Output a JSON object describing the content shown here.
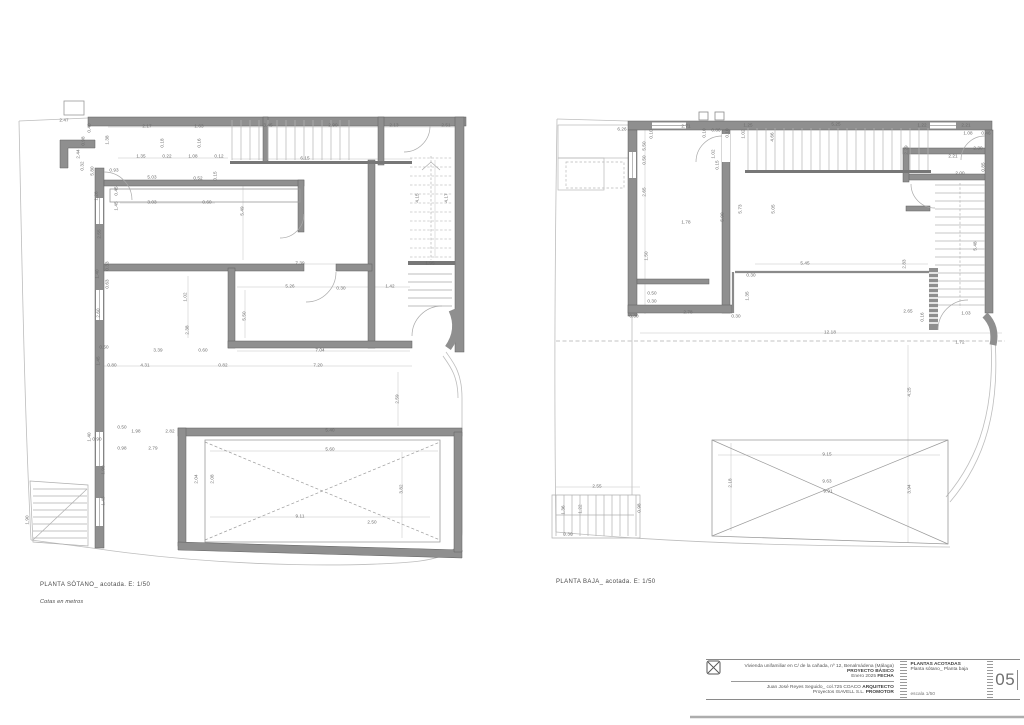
{
  "colors": {
    "wall": "#8f8f8f",
    "thin_line": "#a8a8a8",
    "dim_text": "#6a6a6a",
    "paper": "#ffffff"
  },
  "captions": {
    "left_title": "PLANTA SÓTANO_ acotada. E: 1/50",
    "left_note": "Cotas en metros",
    "right_title": "PLANTA BAJA_ acotada. E: 1/50"
  },
  "title_block": {
    "project_desc": "Vivienda unifamiliar en C/ de la cañada, nº 12, Benalmádena (Málaga)",
    "project_label": "PROYECTO BÁSICO",
    "date_value": "Enero 2025",
    "date_label": "FECHA",
    "architect_value": "Juan José Reyes Seguido_ col.725 COACO",
    "architect_label": "ARQUITECTO",
    "promoter_value": "Proyectos ISAVELL S.L.",
    "promoter_label": "PROMOTOR",
    "sheet_title": "PLANTAS ACOTADAS",
    "sheet_subtitle": "Planta sótano_ Planta baja",
    "scale_note": "escala 1/50",
    "sheet_number": "05"
  },
  "plans": {
    "left": {
      "dims": [
        {
          "x": 147,
          "y": 127,
          "t": "2.17"
        },
        {
          "x": 199,
          "y": 127,
          "t": "1.63"
        },
        {
          "x": 268,
          "y": 126,
          "t": "3.45"
        },
        {
          "x": 333,
          "y": 126,
          "t": "2.90"
        },
        {
          "x": 394,
          "y": 126,
          "t": "2.13"
        },
        {
          "x": 446,
          "y": 126,
          "t": "2.51"
        },
        {
          "x": 163,
          "y": 143,
          "t": "0.18",
          "r": 1
        },
        {
          "x": 200,
          "y": 143,
          "t": "0.16",
          "r": 1
        },
        {
          "x": 141,
          "y": 157,
          "t": "1.35"
        },
        {
          "x": 167,
          "y": 157,
          "t": "0.22"
        },
        {
          "x": 193,
          "y": 157,
          "t": "1.08"
        },
        {
          "x": 219,
          "y": 157,
          "t": "0.12"
        },
        {
          "x": 305,
          "y": 159,
          "t": "6.15"
        },
        {
          "x": 64,
          "y": 121,
          "t": "2.47"
        },
        {
          "x": 90,
          "y": 128,
          "t": "0.40",
          "r": 1
        },
        {
          "x": 84,
          "y": 141,
          "t": "0.98",
          "r": 1
        },
        {
          "x": 79,
          "y": 154,
          "t": "2.44",
          "r": 1
        },
        {
          "x": 83,
          "y": 166,
          "t": "0.32",
          "r": 1
        },
        {
          "x": 108,
          "y": 140,
          "t": "1.38",
          "r": 1
        },
        {
          "x": 93,
          "y": 171,
          "t": "5.80",
          "r": 1
        },
        {
          "x": 114,
          "y": 171,
          "t": "0.93"
        },
        {
          "x": 152,
          "y": 178,
          "t": "5.03"
        },
        {
          "x": 198,
          "y": 179,
          "t": "0.52"
        },
        {
          "x": 216,
          "y": 176,
          "t": "0.15",
          "r": 1
        },
        {
          "x": 117,
          "y": 191,
          "t": "0.45",
          "r": 1
        },
        {
          "x": 97,
          "y": 196,
          "t": "1.26",
          "r": 1
        },
        {
          "x": 152,
          "y": 203,
          "t": "3.03"
        },
        {
          "x": 207,
          "y": 203,
          "t": "0.60"
        },
        {
          "x": 117,
          "y": 206,
          "t": "1.45",
          "r": 1
        },
        {
          "x": 243,
          "y": 211,
          "t": "5.49",
          "r": 1
        },
        {
          "x": 100,
          "y": 234,
          "t": "2.55",
          "r": 1
        },
        {
          "x": 108,
          "y": 266,
          "t": "0.33",
          "r": 1
        },
        {
          "x": 98,
          "y": 274,
          "t": "1.40",
          "r": 1
        },
        {
          "x": 108,
          "y": 284,
          "t": "0.63",
          "r": 1
        },
        {
          "x": 300,
          "y": 264,
          "t": "7.39"
        },
        {
          "x": 290,
          "y": 287,
          "t": "5.26"
        },
        {
          "x": 341,
          "y": 289,
          "t": "0.30"
        },
        {
          "x": 390,
          "y": 287,
          "t": "1.42"
        },
        {
          "x": 186,
          "y": 297,
          "t": "1.02",
          "r": 1
        },
        {
          "x": 99,
          "y": 313,
          "t": "2.60",
          "r": 1
        },
        {
          "x": 188,
          "y": 330,
          "t": "2.38",
          "r": 1
        },
        {
          "x": 245,
          "y": 316,
          "t": "5.50",
          "r": 1
        },
        {
          "x": 418,
          "y": 198,
          "t": "4.15",
          "r": 1
        },
        {
          "x": 447,
          "y": 198,
          "t": "4.17",
          "r": 1
        },
        {
          "x": 430,
          "y": 264,
          "t": "1.95"
        },
        {
          "x": 158,
          "y": 351,
          "t": "3.39"
        },
        {
          "x": 203,
          "y": 351,
          "t": "0.60"
        },
        {
          "x": 104,
          "y": 348,
          "t": "0.50"
        },
        {
          "x": 99,
          "y": 361,
          "t": "1.45",
          "r": 1
        },
        {
          "x": 112,
          "y": 366,
          "t": "0.80"
        },
        {
          "x": 145,
          "y": 366,
          "t": "4.31"
        },
        {
          "x": 223,
          "y": 366,
          "t": "0.82"
        },
        {
          "x": 320,
          "y": 351,
          "t": "7.04"
        },
        {
          "x": 318,
          "y": 366,
          "t": "7.20"
        },
        {
          "x": 398,
          "y": 399,
          "t": "2.59",
          "r": 1
        },
        {
          "x": 122,
          "y": 428,
          "t": "0.50"
        },
        {
          "x": 136,
          "y": 432,
          "t": "1.98"
        },
        {
          "x": 170,
          "y": 432,
          "t": "2.82"
        },
        {
          "x": 330,
          "y": 431,
          "t": "5.40"
        },
        {
          "x": 97,
          "y": 440,
          "t": "0.90"
        },
        {
          "x": 122,
          "y": 449,
          "t": "0.98"
        },
        {
          "x": 153,
          "y": 449,
          "t": "2.79"
        },
        {
          "x": 90,
          "y": 437,
          "t": "1.40",
          "r": 1
        },
        {
          "x": 330,
          "y": 450,
          "t": "5.60"
        },
        {
          "x": 104,
          "y": 470,
          "t": "1.90",
          "r": 1
        },
        {
          "x": 197,
          "y": 479,
          "t": "2.04",
          "r": 1
        },
        {
          "x": 213,
          "y": 479,
          "t": "2.08",
          "r": 1
        },
        {
          "x": 402,
          "y": 489,
          "t": "3.82",
          "r": 1
        },
        {
          "x": 104,
          "y": 501,
          "t": "1.45",
          "r": 1
        },
        {
          "x": 300,
          "y": 517,
          "t": "9.11"
        },
        {
          "x": 372,
          "y": 523,
          "t": "2.50"
        },
        {
          "x": 28,
          "y": 520,
          "t": "1.90",
          "r": 1
        }
      ]
    },
    "right": {
      "dims": [
        {
          "x": 622,
          "y": 130,
          "t": "6.26"
        },
        {
          "x": 686,
          "y": 127,
          "t": "2.71"
        },
        {
          "x": 748,
          "y": 126,
          "t": "1.25"
        },
        {
          "x": 836,
          "y": 125,
          "t": "5.25"
        },
        {
          "x": 922,
          "y": 126,
          "t": "1.22"
        },
        {
          "x": 966,
          "y": 126,
          "t": "2.21"
        },
        {
          "x": 652,
          "y": 134,
          "t": "0.10",
          "r": 1
        },
        {
          "x": 705,
          "y": 133,
          "t": "0.10",
          "r": 1
        },
        {
          "x": 716,
          "y": 131,
          "t": "0.86"
        },
        {
          "x": 728,
          "y": 133,
          "t": "0.10",
          "r": 1
        },
        {
          "x": 744,
          "y": 134,
          "t": "1.02",
          "r": 1
        },
        {
          "x": 773,
          "y": 137,
          "t": "4.66",
          "r": 1
        },
        {
          "x": 968,
          "y": 134,
          "t": "1.08"
        },
        {
          "x": 986,
          "y": 134,
          "t": "0.46"
        },
        {
          "x": 645,
          "y": 146,
          "t": "5.50",
          "r": 1
        },
        {
          "x": 645,
          "y": 160,
          "t": "0.50",
          "r": 1
        },
        {
          "x": 714,
          "y": 154,
          "t": "1.02",
          "r": 1
        },
        {
          "x": 718,
          "y": 165,
          "t": "0.15",
          "r": 1
        },
        {
          "x": 907,
          "y": 150,
          "t": "2.29",
          "r": 1
        },
        {
          "x": 978,
          "y": 149,
          "t": "2.30"
        },
        {
          "x": 953,
          "y": 157,
          "t": "2.21"
        },
        {
          "x": 984,
          "y": 167,
          "t": "0.85",
          "r": 1
        },
        {
          "x": 960,
          "y": 174,
          "t": "2.00"
        },
        {
          "x": 645,
          "y": 192,
          "t": "2.65",
          "r": 1
        },
        {
          "x": 723,
          "y": 217,
          "t": "5.90",
          "r": 1
        },
        {
          "x": 741,
          "y": 209,
          "t": "5.73",
          "r": 1
        },
        {
          "x": 774,
          "y": 209,
          "t": "5.05",
          "r": 1
        },
        {
          "x": 976,
          "y": 246,
          "t": "5.48",
          "r": 1
        },
        {
          "x": 686,
          "y": 223,
          "t": "1.78"
        },
        {
          "x": 647,
          "y": 256,
          "t": "1.50",
          "r": 1
        },
        {
          "x": 805,
          "y": 264,
          "t": "5.45"
        },
        {
          "x": 751,
          "y": 276,
          "t": "0.30"
        },
        {
          "x": 905,
          "y": 264,
          "t": "2.83",
          "r": 1
        },
        {
          "x": 652,
          "y": 294,
          "t": "0.50"
        },
        {
          "x": 652,
          "y": 302,
          "t": "0.30"
        },
        {
          "x": 748,
          "y": 296,
          "t": "1.35",
          "r": 1
        },
        {
          "x": 688,
          "y": 313,
          "t": "2.78"
        },
        {
          "x": 634,
          "y": 317,
          "t": "0.30"
        },
        {
          "x": 736,
          "y": 317,
          "t": "0.30"
        },
        {
          "x": 908,
          "y": 312,
          "t": "2.65"
        },
        {
          "x": 966,
          "y": 314,
          "t": "1.03"
        },
        {
          "x": 923,
          "y": 317,
          "t": "0.16",
          "r": 1
        },
        {
          "x": 830,
          "y": 333,
          "t": "12.18"
        },
        {
          "x": 960,
          "y": 343,
          "t": "1.72"
        },
        {
          "x": 910,
          "y": 392,
          "t": "4.25",
          "r": 1
        },
        {
          "x": 827,
          "y": 455,
          "t": "9.15"
        },
        {
          "x": 731,
          "y": 483,
          "t": "2.18",
          "r": 1
        },
        {
          "x": 827,
          "y": 482,
          "t": "9.63"
        },
        {
          "x": 828,
          "y": 492,
          "t": "9.91"
        },
        {
          "x": 910,
          "y": 489,
          "t": "3.94",
          "r": 1
        },
        {
          "x": 597,
          "y": 487,
          "t": "2.55"
        },
        {
          "x": 564,
          "y": 510,
          "t": "1.36",
          "r": 1
        },
        {
          "x": 581,
          "y": 509,
          "t": "1.22",
          "r": 1
        },
        {
          "x": 640,
          "y": 508,
          "t": "0.98",
          "r": 1
        },
        {
          "x": 568,
          "y": 535,
          "t": "0.30"
        }
      ]
    }
  }
}
